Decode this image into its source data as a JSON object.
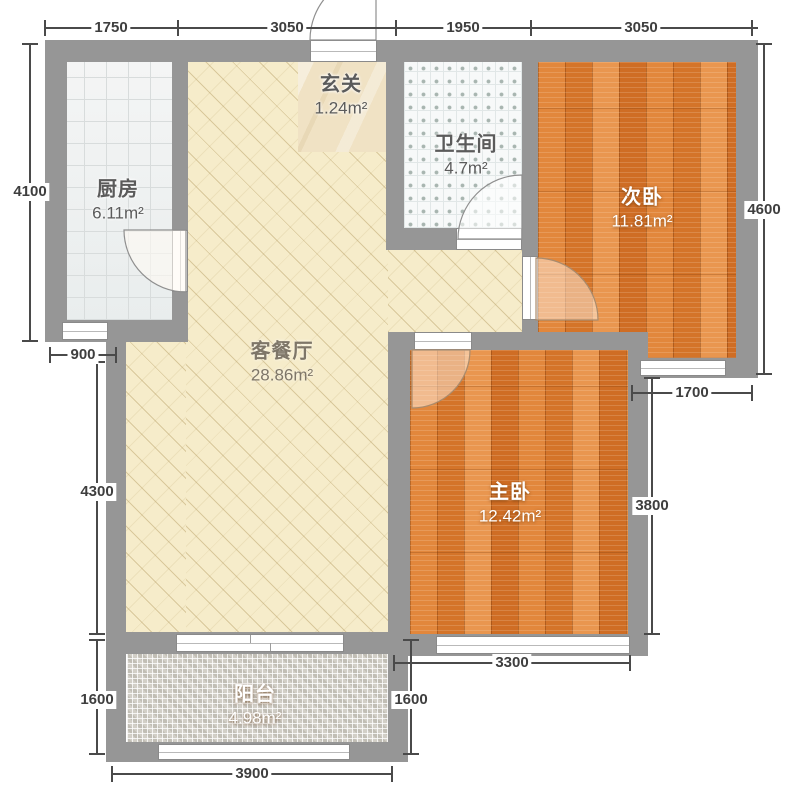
{
  "rooms": {
    "kitchen": {
      "name": "厨房",
      "area": "6.11m²"
    },
    "foyer": {
      "name": "玄关",
      "area": "1.24m²"
    },
    "bathroom": {
      "name": "卫生间",
      "area": "4.7m²"
    },
    "second_bedroom": {
      "name": "次卧",
      "area": "11.81m²"
    },
    "living_dining": {
      "name": "客餐厅",
      "area": "28.86m²"
    },
    "master_bedroom": {
      "name": "主卧",
      "area": "12.42m²"
    },
    "balcony": {
      "name": "阳台",
      "area": "4.98m²"
    }
  },
  "dimensions": {
    "top": [
      "1750",
      "3050",
      "1950",
      "3050"
    ],
    "left": [
      "4100",
      "900",
      "4300",
      "1600"
    ],
    "bottom": [
      "3900",
      "3300",
      "1600"
    ],
    "right": [
      "4600",
      "1700",
      "3800"
    ]
  },
  "colors": {
    "wall": "#969696",
    "living_floor": "#f6ecca",
    "wood_floor": "#db7e30",
    "kitchen_floor": "#edf0f0",
    "bathroom_floor": "#f7f9f9",
    "balcony_floor": "#d2cfc7",
    "dimension_text": "#3e3e3e"
  }
}
